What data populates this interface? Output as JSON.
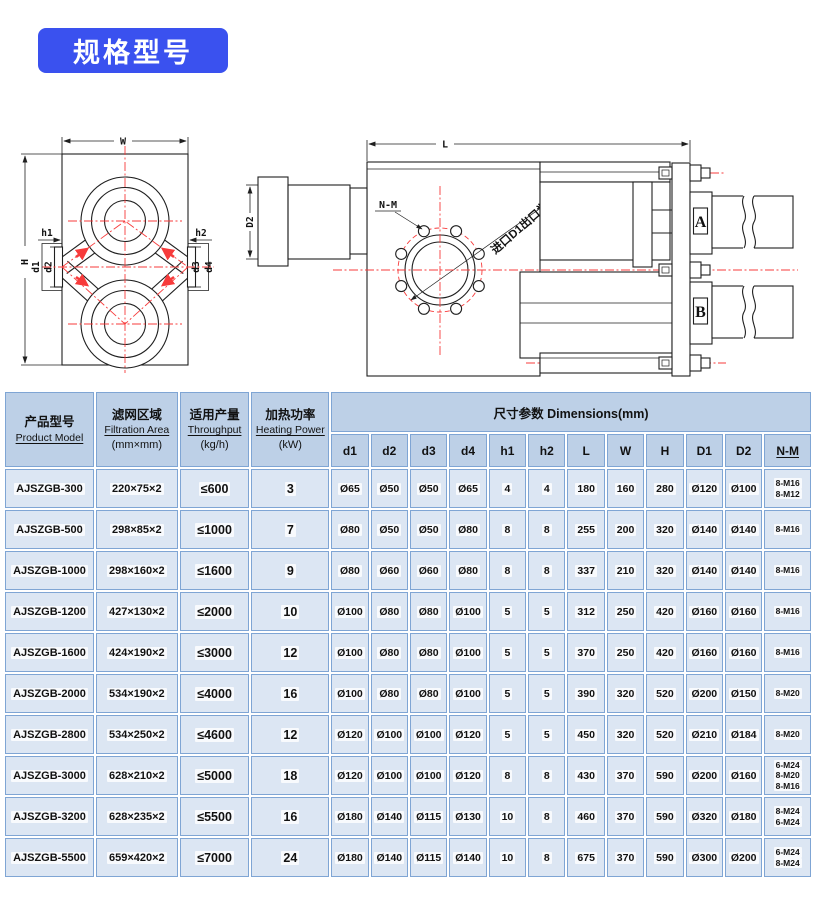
{
  "title": {
    "text": "规格型号"
  },
  "colors": {
    "accent_blue": "#3a51ef",
    "table_header_bg": "#bdd0e7",
    "table_row_bg": "#dce6f3",
    "table_grid_border": "#7fa5d4",
    "hatch_green": "#74c56f",
    "dot_green": "#3fae46",
    "centerline_red": "#f73b3b",
    "drawing_line": "#1f1f1f"
  },
  "front_view": {
    "labels": {
      "w": "W",
      "h": "H",
      "h1": "h1",
      "h2": "h2",
      "d1": "d1",
      "d2": "d2",
      "d3": "d3",
      "d4": "d4"
    }
  },
  "side_view": {
    "labels": {
      "l": "L",
      "d2": "D2",
      "nm": "N-M",
      "note": "进口D1出口为D2",
      "a": "A",
      "b": "B"
    }
  },
  "table": {
    "group_header": "尺寸参数 Dimensions(mm)",
    "fixed_columns": [
      {
        "zh": "产品型号",
        "en": "Product Model"
      },
      {
        "zh": "滤网区域",
        "en": "Filtration Area",
        "unit": "(mm×mm)"
      },
      {
        "zh": "适用产量",
        "en": "Throughput",
        "unit": "(kg/h)"
      },
      {
        "zh": "加热功率",
        "en": "Heating Power",
        "unit": "(kW)"
      }
    ],
    "dim_columns": [
      "d1",
      "d2",
      "d3",
      "d4",
      "h1",
      "h2",
      "L",
      "W",
      "H",
      "D1",
      "D2",
      "N-M"
    ],
    "rows": [
      [
        "AJSZGB-300",
        "220×75×2",
        "≤600",
        "3",
        "Ø65",
        "Ø50",
        "Ø50",
        "Ø65",
        "4",
        "4",
        "180",
        "160",
        "280",
        "Ø120",
        "Ø100",
        [
          "8-M16",
          "8-M12"
        ]
      ],
      [
        "AJSZGB-500",
        "298×85×2",
        "≤1000",
        "7",
        "Ø80",
        "Ø50",
        "Ø50",
        "Ø80",
        "8",
        "8",
        "255",
        "200",
        "320",
        "Ø140",
        "Ø140",
        [
          "8-M16"
        ]
      ],
      [
        "AJSZGB-1000",
        "298×160×2",
        "≤1600",
        "9",
        "Ø80",
        "Ø60",
        "Ø60",
        "Ø80",
        "8",
        "8",
        "337",
        "210",
        "320",
        "Ø140",
        "Ø140",
        [
          "8-M16"
        ]
      ],
      [
        "AJSZGB-1200",
        "427×130×2",
        "≤2000",
        "10",
        "Ø100",
        "Ø80",
        "Ø80",
        "Ø100",
        "5",
        "5",
        "312",
        "250",
        "420",
        "Ø160",
        "Ø160",
        [
          "8-M16"
        ]
      ],
      [
        "AJSZGB-1600",
        "424×190×2",
        "≤3000",
        "12",
        "Ø100",
        "Ø80",
        "Ø80",
        "Ø100",
        "5",
        "5",
        "370",
        "250",
        "420",
        "Ø160",
        "Ø160",
        [
          "8-M16"
        ]
      ],
      [
        "AJSZGB-2000",
        "534×190×2",
        "≤4000",
        "16",
        "Ø100",
        "Ø80",
        "Ø80",
        "Ø100",
        "5",
        "5",
        "390",
        "320",
        "520",
        "Ø200",
        "Ø150",
        [
          "8-M20"
        ]
      ],
      [
        "AJSZGB-2800",
        "534×250×2",
        "≤4600",
        "12",
        "Ø120",
        "Ø100",
        "Ø100",
        "Ø120",
        "5",
        "5",
        "450",
        "320",
        "520",
        "Ø210",
        "Ø184",
        [
          "8-M20"
        ]
      ],
      [
        "AJSZGB-3000",
        "628×210×2",
        "≤5000",
        "18",
        "Ø120",
        "Ø100",
        "Ø100",
        "Ø120",
        "8",
        "8",
        "430",
        "370",
        "590",
        "Ø200",
        "Ø160",
        [
          "6-M24",
          "8-M20",
          "8-M16"
        ]
      ],
      [
        "AJSZGB-3200",
        "628×235×2",
        "≤5500",
        "16",
        "Ø180",
        "Ø140",
        "Ø115",
        "Ø130",
        "10",
        "8",
        "460",
        "370",
        "590",
        "Ø320",
        "Ø180",
        [
          "8-M24",
          "6-M24"
        ]
      ],
      [
        "AJSZGB-5500",
        "659×420×2",
        "≤7000",
        "24",
        "Ø180",
        "Ø140",
        "Ø115",
        "Ø140",
        "10",
        "8",
        "675",
        "370",
        "590",
        "Ø300",
        "Ø200",
        [
          "6-M24",
          "8-M24"
        ]
      ]
    ]
  }
}
